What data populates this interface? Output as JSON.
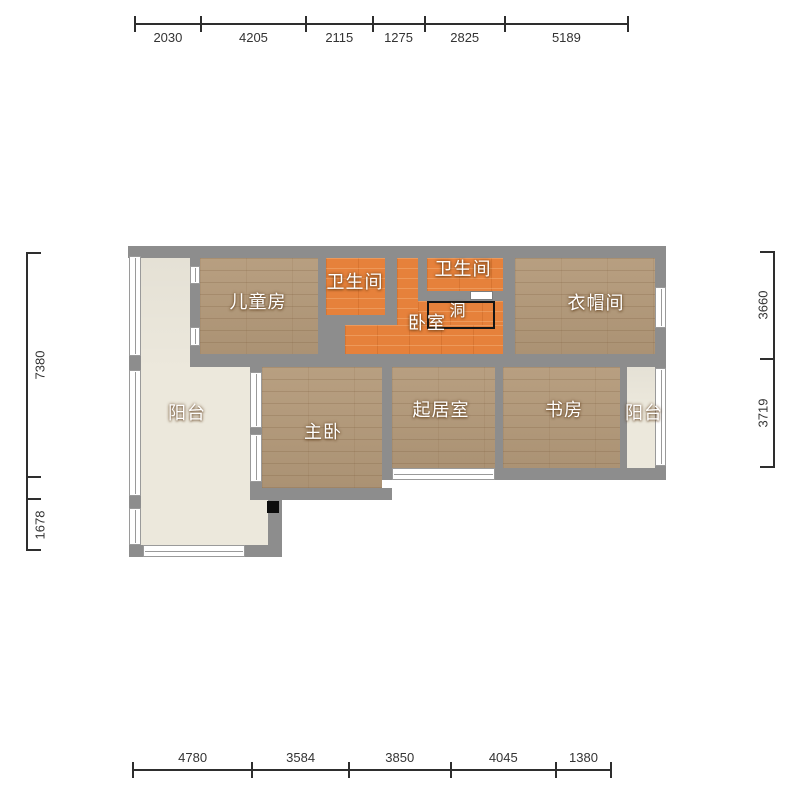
{
  "rooms": {
    "children": {
      "label": "儿童房"
    },
    "bathroom_top": {
      "label": "卫生间"
    },
    "bathroom_right": {
      "label": "卫生间"
    },
    "bedroom": {
      "label": "卧室"
    },
    "opening": {
      "label": "洞"
    },
    "cloakroom": {
      "label": "衣帽间"
    },
    "balcony_left": {
      "label": "阳台"
    },
    "master_bedroom": {
      "label": "主卧"
    },
    "living_room": {
      "label": "起居室"
    },
    "study": {
      "label": "书房"
    },
    "balcony_right": {
      "label": "阳台"
    }
  },
  "dims": {
    "top": [
      "2030",
      "4205",
      "2115",
      "1275",
      "2825",
      "5189"
    ],
    "bottom": [
      "4780",
      "3584",
      "3850",
      "4045",
      "1380"
    ],
    "left": [
      "7380",
      "",
      "1678"
    ],
    "right": [
      "3660",
      "3719"
    ]
  },
  "colors": {
    "wall": "#8d8d8d",
    "wood_floor": "#b49a7a",
    "tile_orange": "#e6813b",
    "balcony_floor": "#ece8dc",
    "dimension_line": "#2e2e2e",
    "label_text": "#ffffff"
  }
}
